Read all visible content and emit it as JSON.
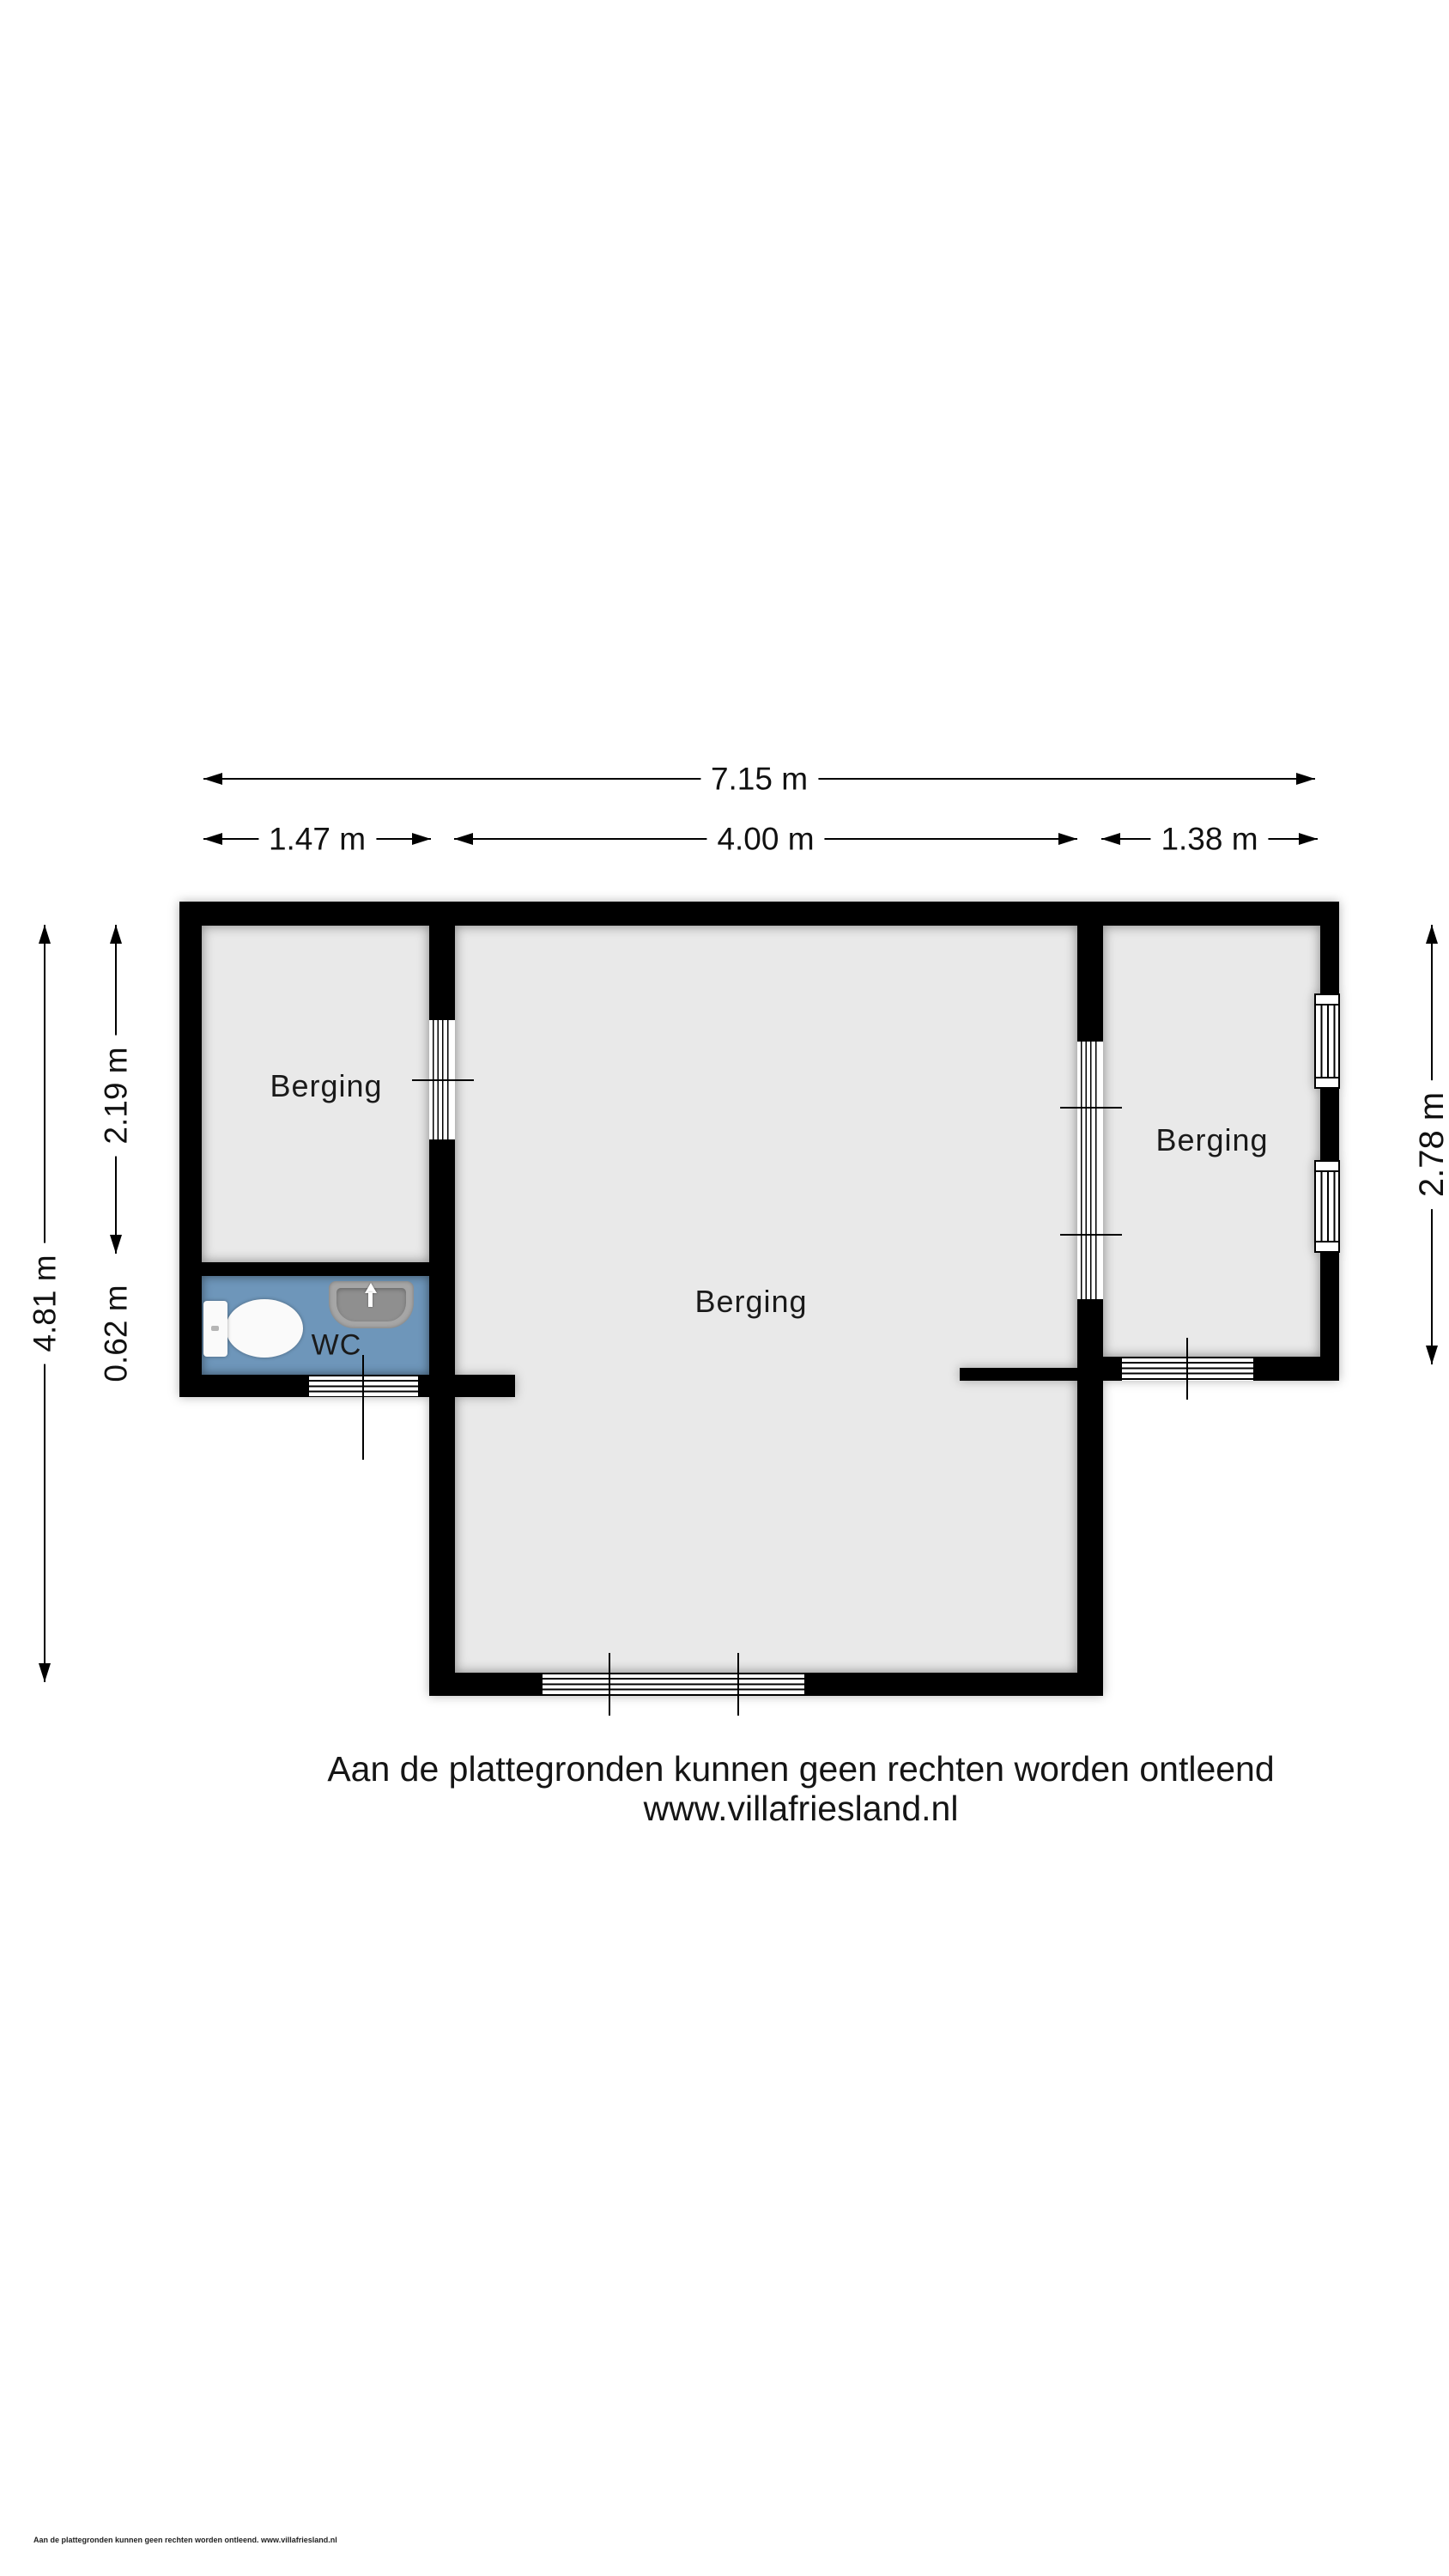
{
  "floorplan": {
    "rooms": [
      {
        "id": "berging-left",
        "label": "Berging"
      },
      {
        "id": "berging-middle",
        "label": "Berging"
      },
      {
        "id": "berging-right",
        "label": "Berging"
      },
      {
        "id": "wc",
        "label": "WC"
      }
    ],
    "dimensions": {
      "total_width": "7.15 m",
      "left_section_width": "1.47 m",
      "middle_section_width": "4.00 m",
      "right_section_width": "1.38 m",
      "left_total_height": "4.81 m",
      "left_room_height": "2.19 m",
      "wc_height": "0.62 m",
      "right_room_height": "2.78 m"
    },
    "colors": {
      "wall": "#000000",
      "floor": "#e9e9e9",
      "wc_floor": "#6e96ba",
      "fixture_gray": "#a6a6a6"
    }
  },
  "footer": {
    "disclaimer": "Aan de plattegronden kunnen geen rechten worden ontleend",
    "website": "www.villafriesland.nl",
    "fine_print": "Aan de plattegronden kunnen geen rechten worden ontleend. www.villafriesland.nl"
  }
}
